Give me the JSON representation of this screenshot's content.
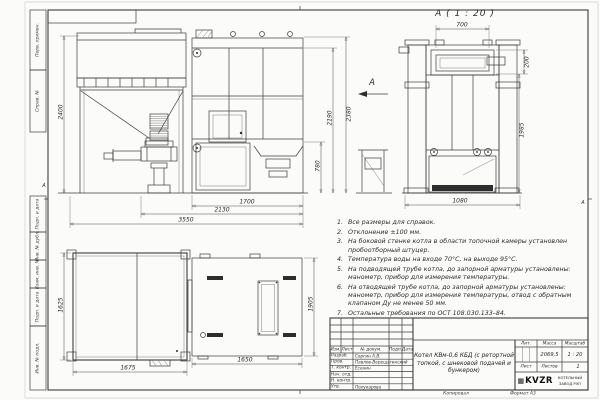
{
  "sheet": {
    "view_a_title": "А ( 1 : 20 )",
    "view_arrow_label": "А",
    "zone_marker_left": "А",
    "zone_marker_right": "А",
    "copy_label": "Копировал",
    "format_label": "Формат А3"
  },
  "frame_labels": {
    "perv_primen": "Перв. примен.",
    "sprav_no": "Справ. №",
    "podp_data_1": "Подп. и дата",
    "inv_dubl": "Инв. № дубл.",
    "vzam_inv": "Взам. инв. №",
    "podp_data_2": "Подп. и дата",
    "inv_podl": "Инв. № подл."
  },
  "dimensions": {
    "front": {
      "platform_height": "2400",
      "overall_height": "2380",
      "boiler_height": "2190",
      "feeder_height": "780",
      "boiler_width": "1700",
      "feeder_span": "2130",
      "overall_width": "3550"
    },
    "view_a": {
      "top_width": "700",
      "collar_height": "200",
      "body_height": "1985",
      "base_width": "1080"
    },
    "top_view": {
      "platform_depth": "1625",
      "platform_width": "1675",
      "boiler_width": "1650",
      "boiler_depth": "1905"
    }
  },
  "notes": {
    "items": [
      {
        "num": "1.",
        "text": "Все размеры для справок."
      },
      {
        "num": "2.",
        "text": "Отклонение ±100 мм."
      },
      {
        "num": "3.",
        "text": "На боковой стенке котла в области топочной камеры установлен пробоотборный штуцер."
      },
      {
        "num": "4.",
        "text": "Температура воды на входе 70°С, на выходе 95°С."
      },
      {
        "num": "5.",
        "text": "На подводящей трубе котла, до запорной арматуры установлены: манометр, прибор для измерения температуры."
      },
      {
        "num": "6.",
        "text": "На отводящей трубе котла, до запорной арматуры установлены: манометр, прибор для измерения температуры, отвод с обратным клапаном Ду не менее 50 мм."
      },
      {
        "num": "7.",
        "text": "Остальные требования по ОСТ 108.030.133–84."
      }
    ]
  },
  "title_block": {
    "header": {
      "izm": "Изм.",
      "list": "Лист",
      "doc": "№ докум.",
      "podp": "Подп.",
      "data": "Дата"
    },
    "rows": [
      {
        "role": "Разраб.",
        "name": "Сергин А.В."
      },
      {
        "role": "Пров.",
        "name": "Павлов-Верещагинский"
      },
      {
        "role": "Т. контр.",
        "name": "Есенин"
      },
      {
        "role": "Нач. отд.",
        "name": ""
      },
      {
        "role": "Н. контр.",
        "name": ""
      },
      {
        "role": "Утв.",
        "name": "Полукарова"
      }
    ],
    "title": "Котел КВм-0,6 КБД (с ретортной топкой, с шнековой подачей и бункером)",
    "lit_label": "Лит.",
    "mass_label": "Масса",
    "scale_label": "Масштаб",
    "mass_value": "2069,5",
    "scale_value": "1 : 20",
    "sheet_label": "Лист",
    "sheets_label": "Листов",
    "sheets_value": "1",
    "logo_icon": "▦",
    "logo_text": "KVZR",
    "logo_sub1": "КОТЕЛЬНЫЙ",
    "logo_sub2": "ЗАВОД РЭП"
  }
}
